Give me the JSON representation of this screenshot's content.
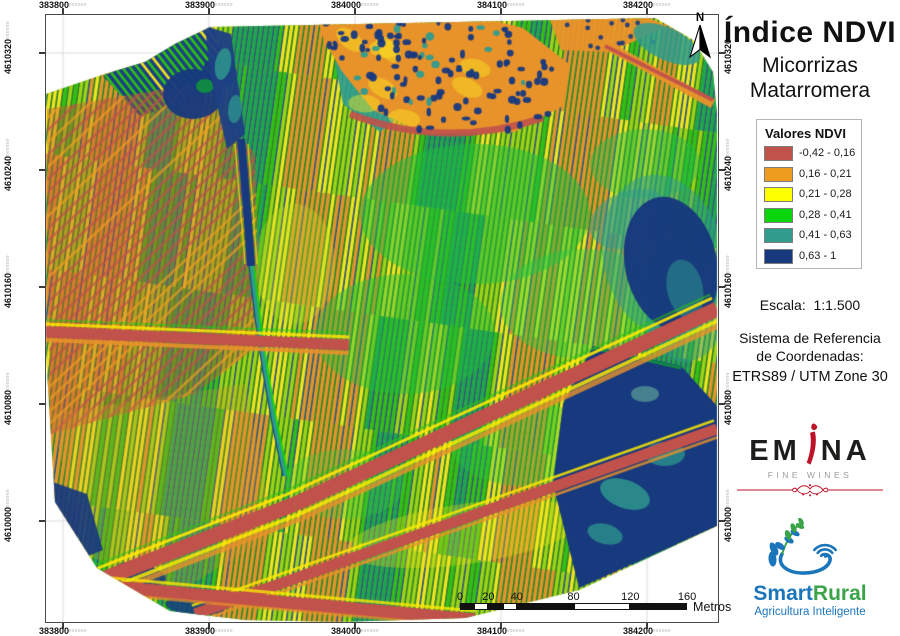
{
  "header": {
    "title": "Índice NDVI",
    "subtitle1": "Micorrizas",
    "subtitle2": "Matarromera"
  },
  "legend": {
    "title": "Valores NDVI",
    "classes": [
      {
        "label": "-0,42 - 0,16",
        "color": "#C1514B"
      },
      {
        "label": "0,16 - 0,21",
        "color": "#EE9C20"
      },
      {
        "label": "0,21 - 0,28",
        "color": "#FCFF00"
      },
      {
        "label": "0,28 - 0,41",
        "color": "#0BD60B"
      },
      {
        "label": "0,41 - 0,63",
        "color": "#2F9C8E"
      },
      {
        "label": "0,63 - 1",
        "color": "#17397E"
      }
    ]
  },
  "scale_text": "Escala:  1:1.500",
  "crs": {
    "line1": "Sistema de Referencia",
    "line2": "de Coordenadas:",
    "line3": "ETRS89 / UTM Zone 30"
  },
  "grid": {
    "x_labels": [
      "383800",
      "383900",
      "384000",
      "384100",
      "384200"
    ],
    "y_labels": [
      "4610320",
      "4610240",
      "4610160",
      "4610080",
      "4610000"
    ],
    "label_suffix": "000000"
  },
  "north": {
    "label": "N"
  },
  "scalebar": {
    "tick_labels": [
      "0",
      "20",
      "40",
      "80",
      "120",
      "160"
    ],
    "tick_meters": [
      0,
      20,
      40,
      80,
      120,
      160
    ],
    "unit": "Metros",
    "segments_m": [
      [
        0,
        10,
        "black"
      ],
      [
        10,
        20,
        "white"
      ],
      [
        20,
        30,
        "black"
      ],
      [
        30,
        40,
        "white"
      ],
      [
        40,
        80,
        "black"
      ],
      [
        80,
        120,
        "white"
      ],
      [
        120,
        160,
        "black"
      ]
    ]
  },
  "logos": {
    "emina": {
      "part1": "EM",
      "part2": "NA",
      "tagline": "FINE WINES",
      "accent_color": "#BE1228",
      "text_color": "#1D1D1B"
    },
    "smartrural": {
      "word1": "Smart",
      "word2": "Rural",
      "tagline": "Agricultura Inteligente",
      "blue": "#1B75BB",
      "green": "#3BA449"
    }
  }
}
